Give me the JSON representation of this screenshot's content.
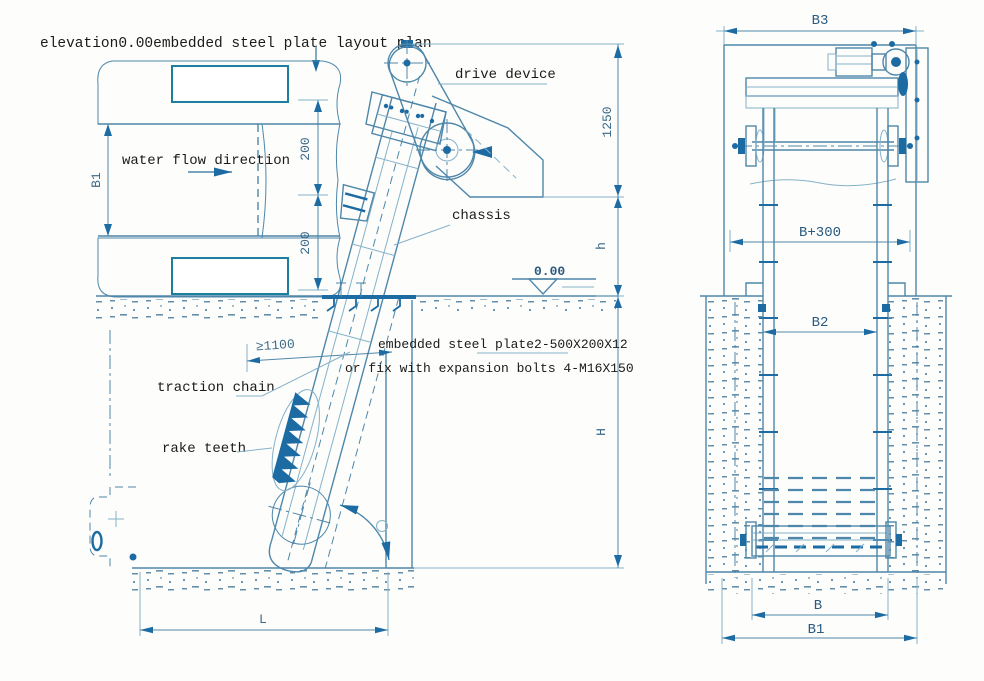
{
  "title": "elevation0.00embedded steel plate layout plan",
  "plan": {
    "water_flow": "water flow direction",
    "b1": "B1",
    "offset_a": "200",
    "offset_b": "200"
  },
  "elevation": {
    "drive_device": "drive device",
    "chassis": "chassis",
    "traction_chain": "traction chain",
    "rake_teeth": "rake teeth",
    "plate_line1": "embedded steel plate2-500X200X12",
    "plate_line2": "or fix with expansion bolts 4-M16X150",
    "level": "0.00",
    "dim_1250": "1250",
    "dim_h_small": "h",
    "dim_h_big": "H",
    "dim_min_1100": "≥1100",
    "dim_l": "L"
  },
  "front": {
    "dim_b3": "B3",
    "dim_b300": "B+300",
    "dim_b2": "B2",
    "dim_b": "B",
    "dim_b1": "B1"
  },
  "colors": {
    "c-line": "#4e87aa",
    "c-line-dark": "#1c6ba3",
    "c-plate": "#1d7e9f",
    "c-text": "#1b1b1b",
    "c-dim": "#3d6a88",
    "c-dim-strong": "#2a5a80",
    "c-bg": "#fdfdfc"
  }
}
